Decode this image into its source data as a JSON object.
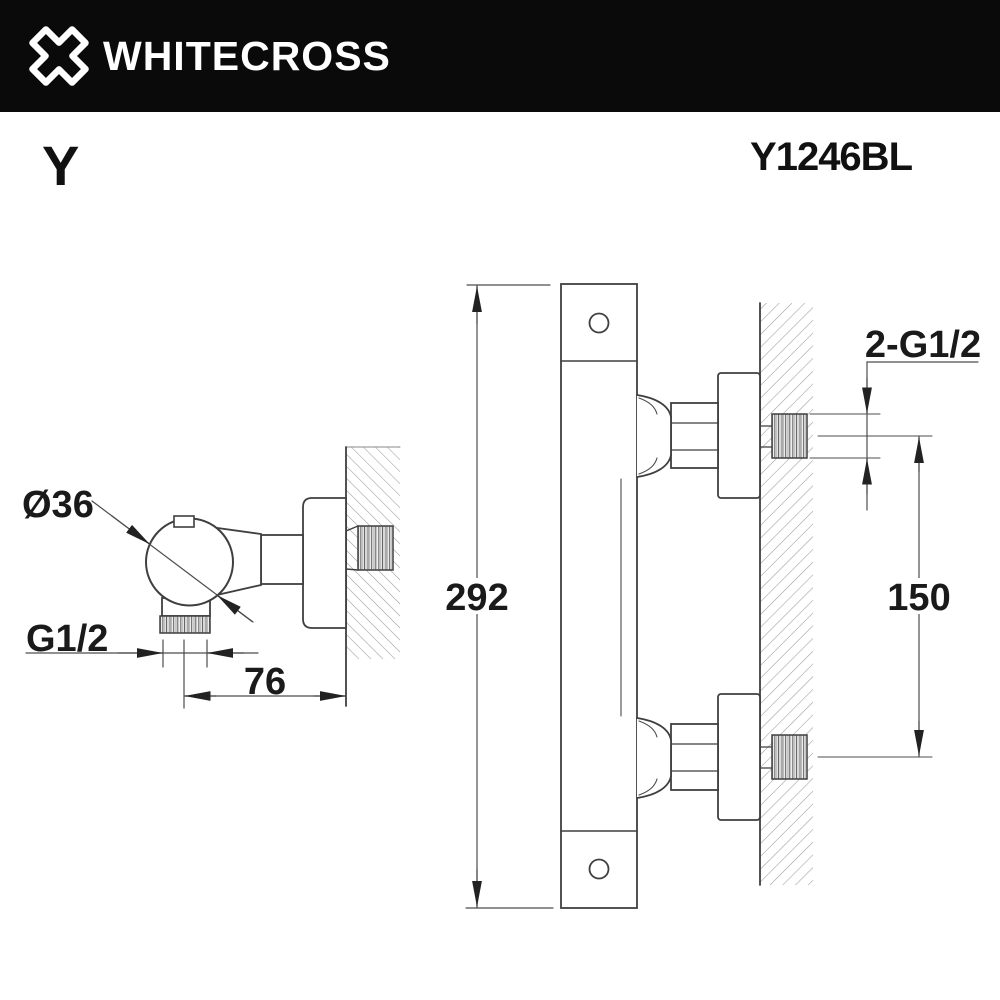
{
  "header": {
    "brand": "WHITECROSS",
    "bg_color": "#0a0a0a",
    "text_color": "#ffffff"
  },
  "product": {
    "series": "Y",
    "code": "Y1246BL"
  },
  "drawing": {
    "kind": "technical dimension drawing of wall-mounted shower mixer",
    "views": [
      "side view with wall section",
      "front view with wall section"
    ],
    "dimensions": {
      "handle_diameter": "Ø36",
      "outlet_thread": "G1/2",
      "wall_offset": "76",
      "body_height": "292",
      "inlet_spacing": "150",
      "inlet_threads": "2-G1/2"
    },
    "colors": {
      "line": "#3f3f3f",
      "dimension": "#4d4d4d",
      "hatch": "#9a9a9a",
      "text": "#1a1a1a",
      "background": "#ffffff"
    }
  }
}
